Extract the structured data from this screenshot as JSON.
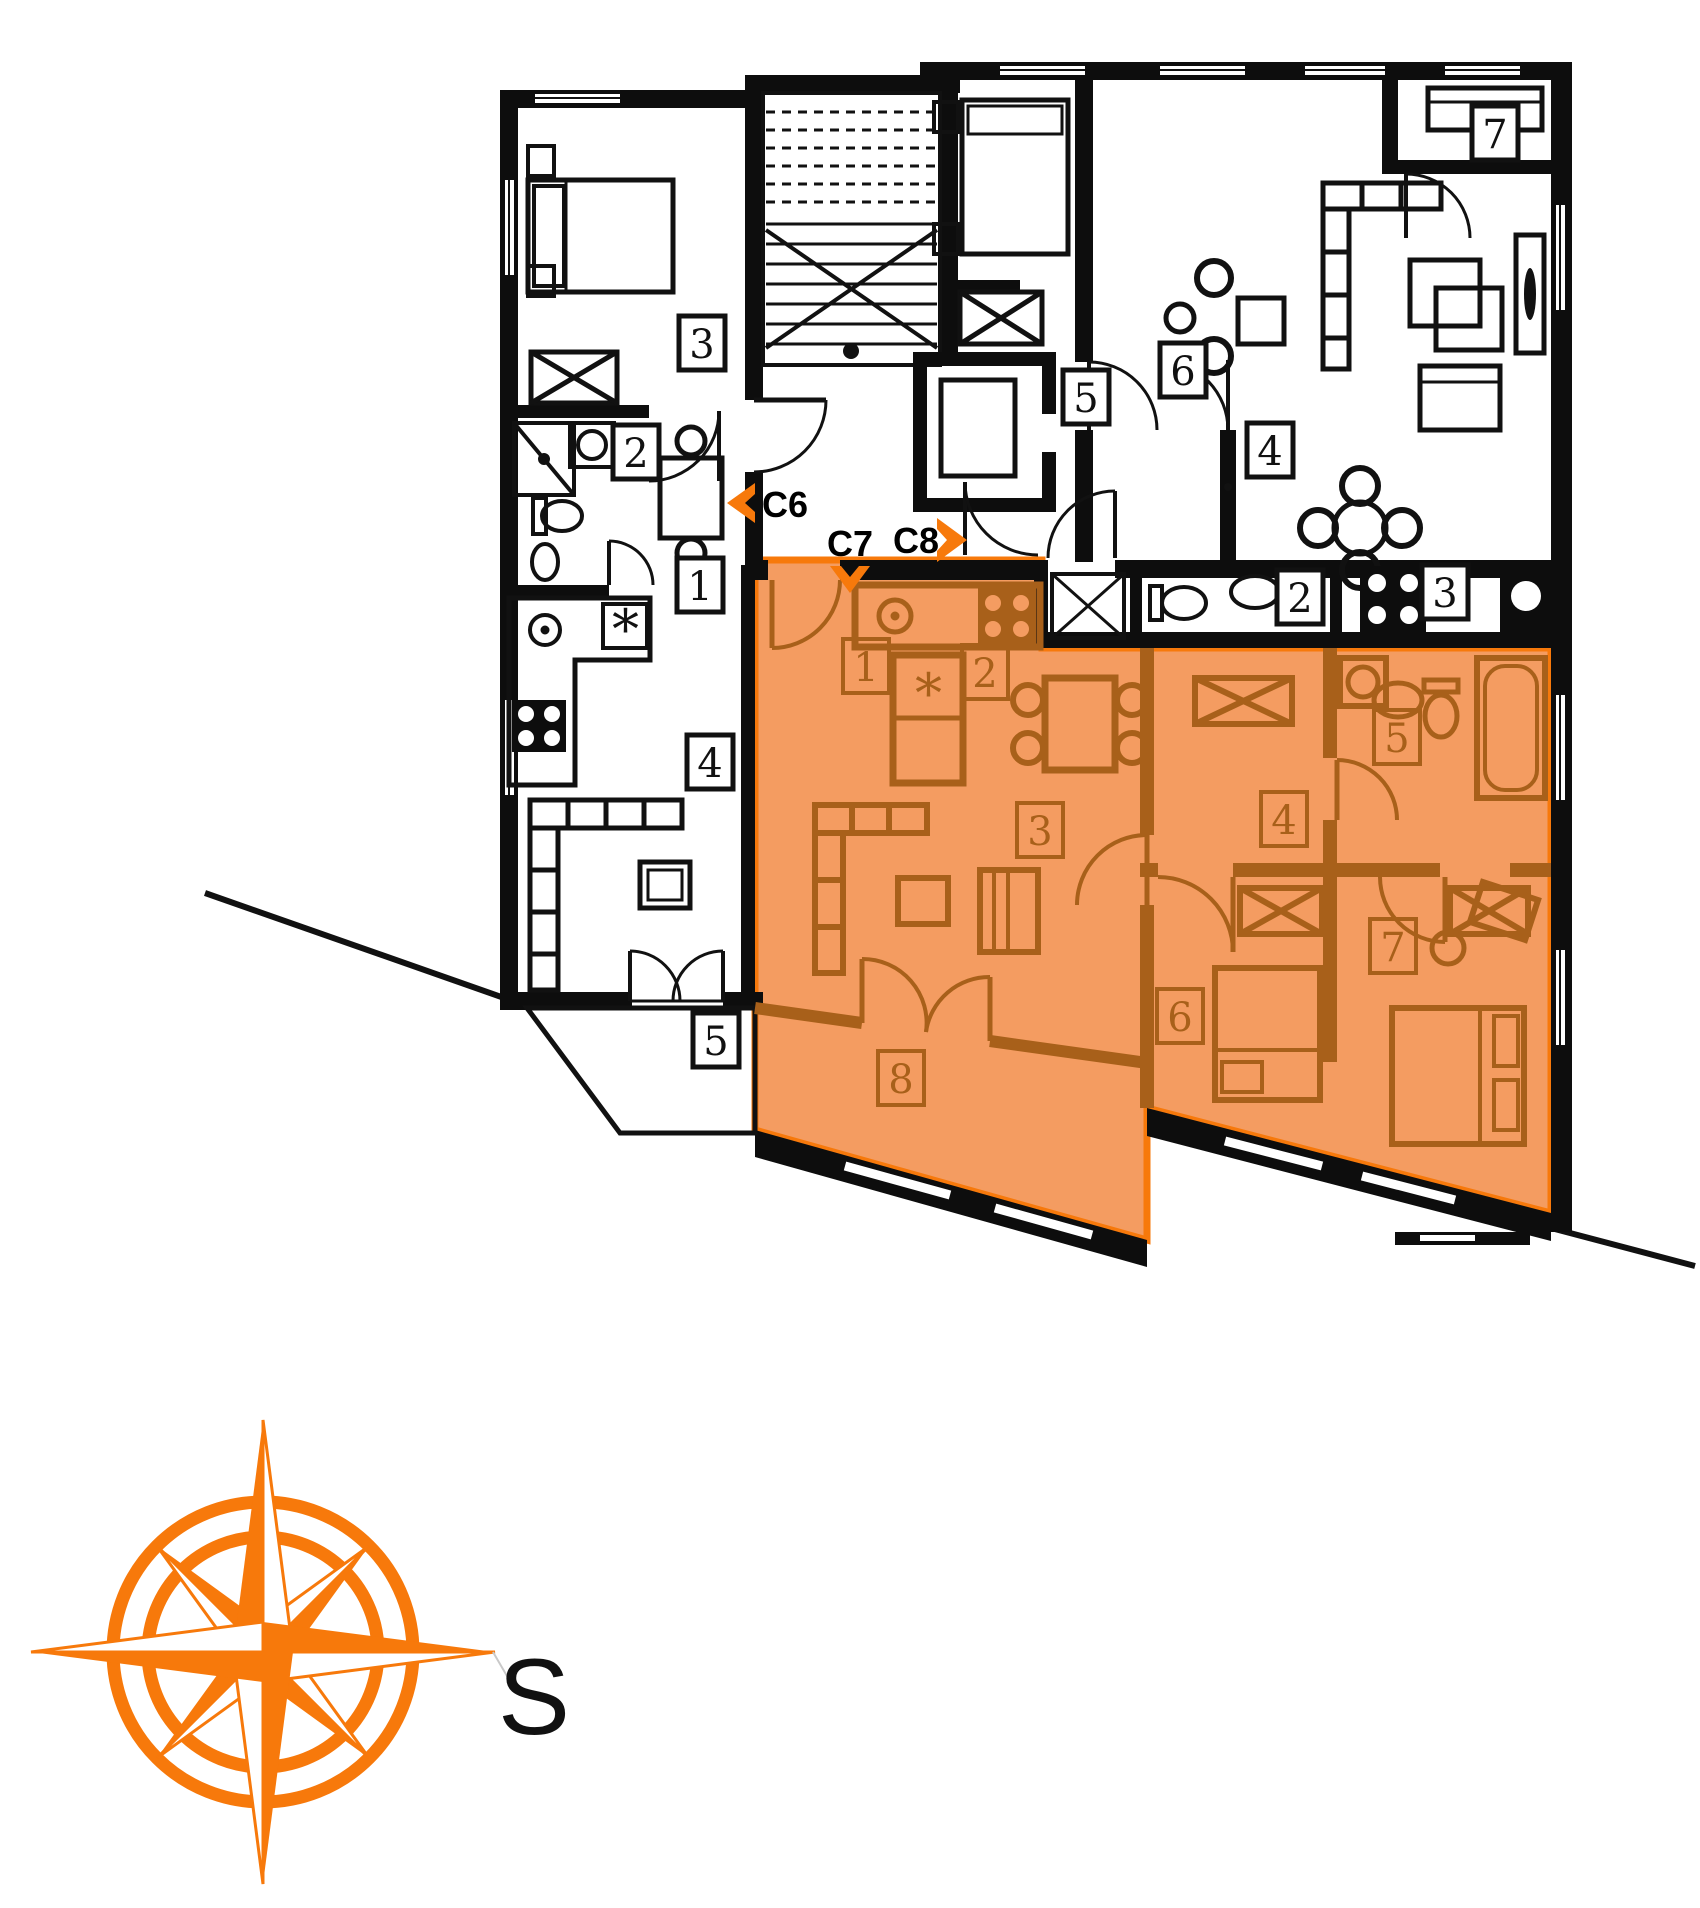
{
  "plan": {
    "colors": {
      "accent_orange": "#f7790b",
      "highlight_fill": "#f49c61",
      "highlight_furniture": "#a8601a",
      "wall_black": "#0d0d0d"
    },
    "units": [
      {
        "id": "C6",
        "label": "C6",
        "arrow_direction": "left",
        "highlighted": false,
        "fridge_symbol": "*",
        "rooms": [
          {
            "number": "1"
          },
          {
            "number": "2"
          },
          {
            "number": "3"
          },
          {
            "number": "4"
          },
          {
            "number": "5"
          }
        ]
      },
      {
        "id": "C7",
        "label": "C7",
        "arrow_direction": "down",
        "highlighted": true,
        "fridge_symbol": "*",
        "rooms": [
          {
            "number": "1"
          },
          {
            "number": "2"
          },
          {
            "number": "3"
          },
          {
            "number": "4"
          },
          {
            "number": "5"
          },
          {
            "number": "6"
          },
          {
            "number": "7"
          },
          {
            "number": "8"
          }
        ]
      },
      {
        "id": "C8",
        "label": "C8",
        "arrow_direction": "right",
        "highlighted": false,
        "rooms": [
          {
            "number": "2"
          },
          {
            "number": "3"
          },
          {
            "number": "4"
          },
          {
            "number": "5"
          },
          {
            "number": "6"
          },
          {
            "number": "7"
          }
        ]
      }
    ],
    "compass": {
      "south_label": "S"
    }
  }
}
